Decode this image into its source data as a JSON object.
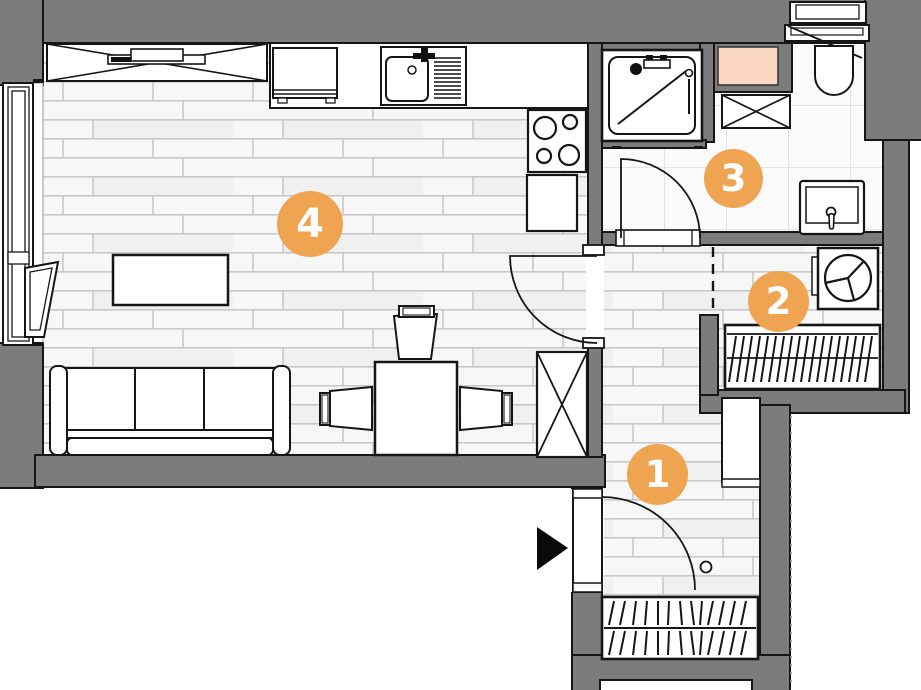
{
  "rooms": [
    {
      "label": "1"
    },
    {
      "label": "2"
    },
    {
      "label": "3"
    },
    {
      "label": "4"
    }
  ],
  "colors": {
    "wall": "#7c7c7c",
    "outline": "#161616",
    "badge": "#efa452",
    "badge_text": "#ffffff",
    "duct": "#fcd8c3",
    "floor": "#f7f7f7",
    "plank_line": "#c9c9c9",
    "tile": "#fbfbfb",
    "tile_line": "#dcdcdc"
  }
}
